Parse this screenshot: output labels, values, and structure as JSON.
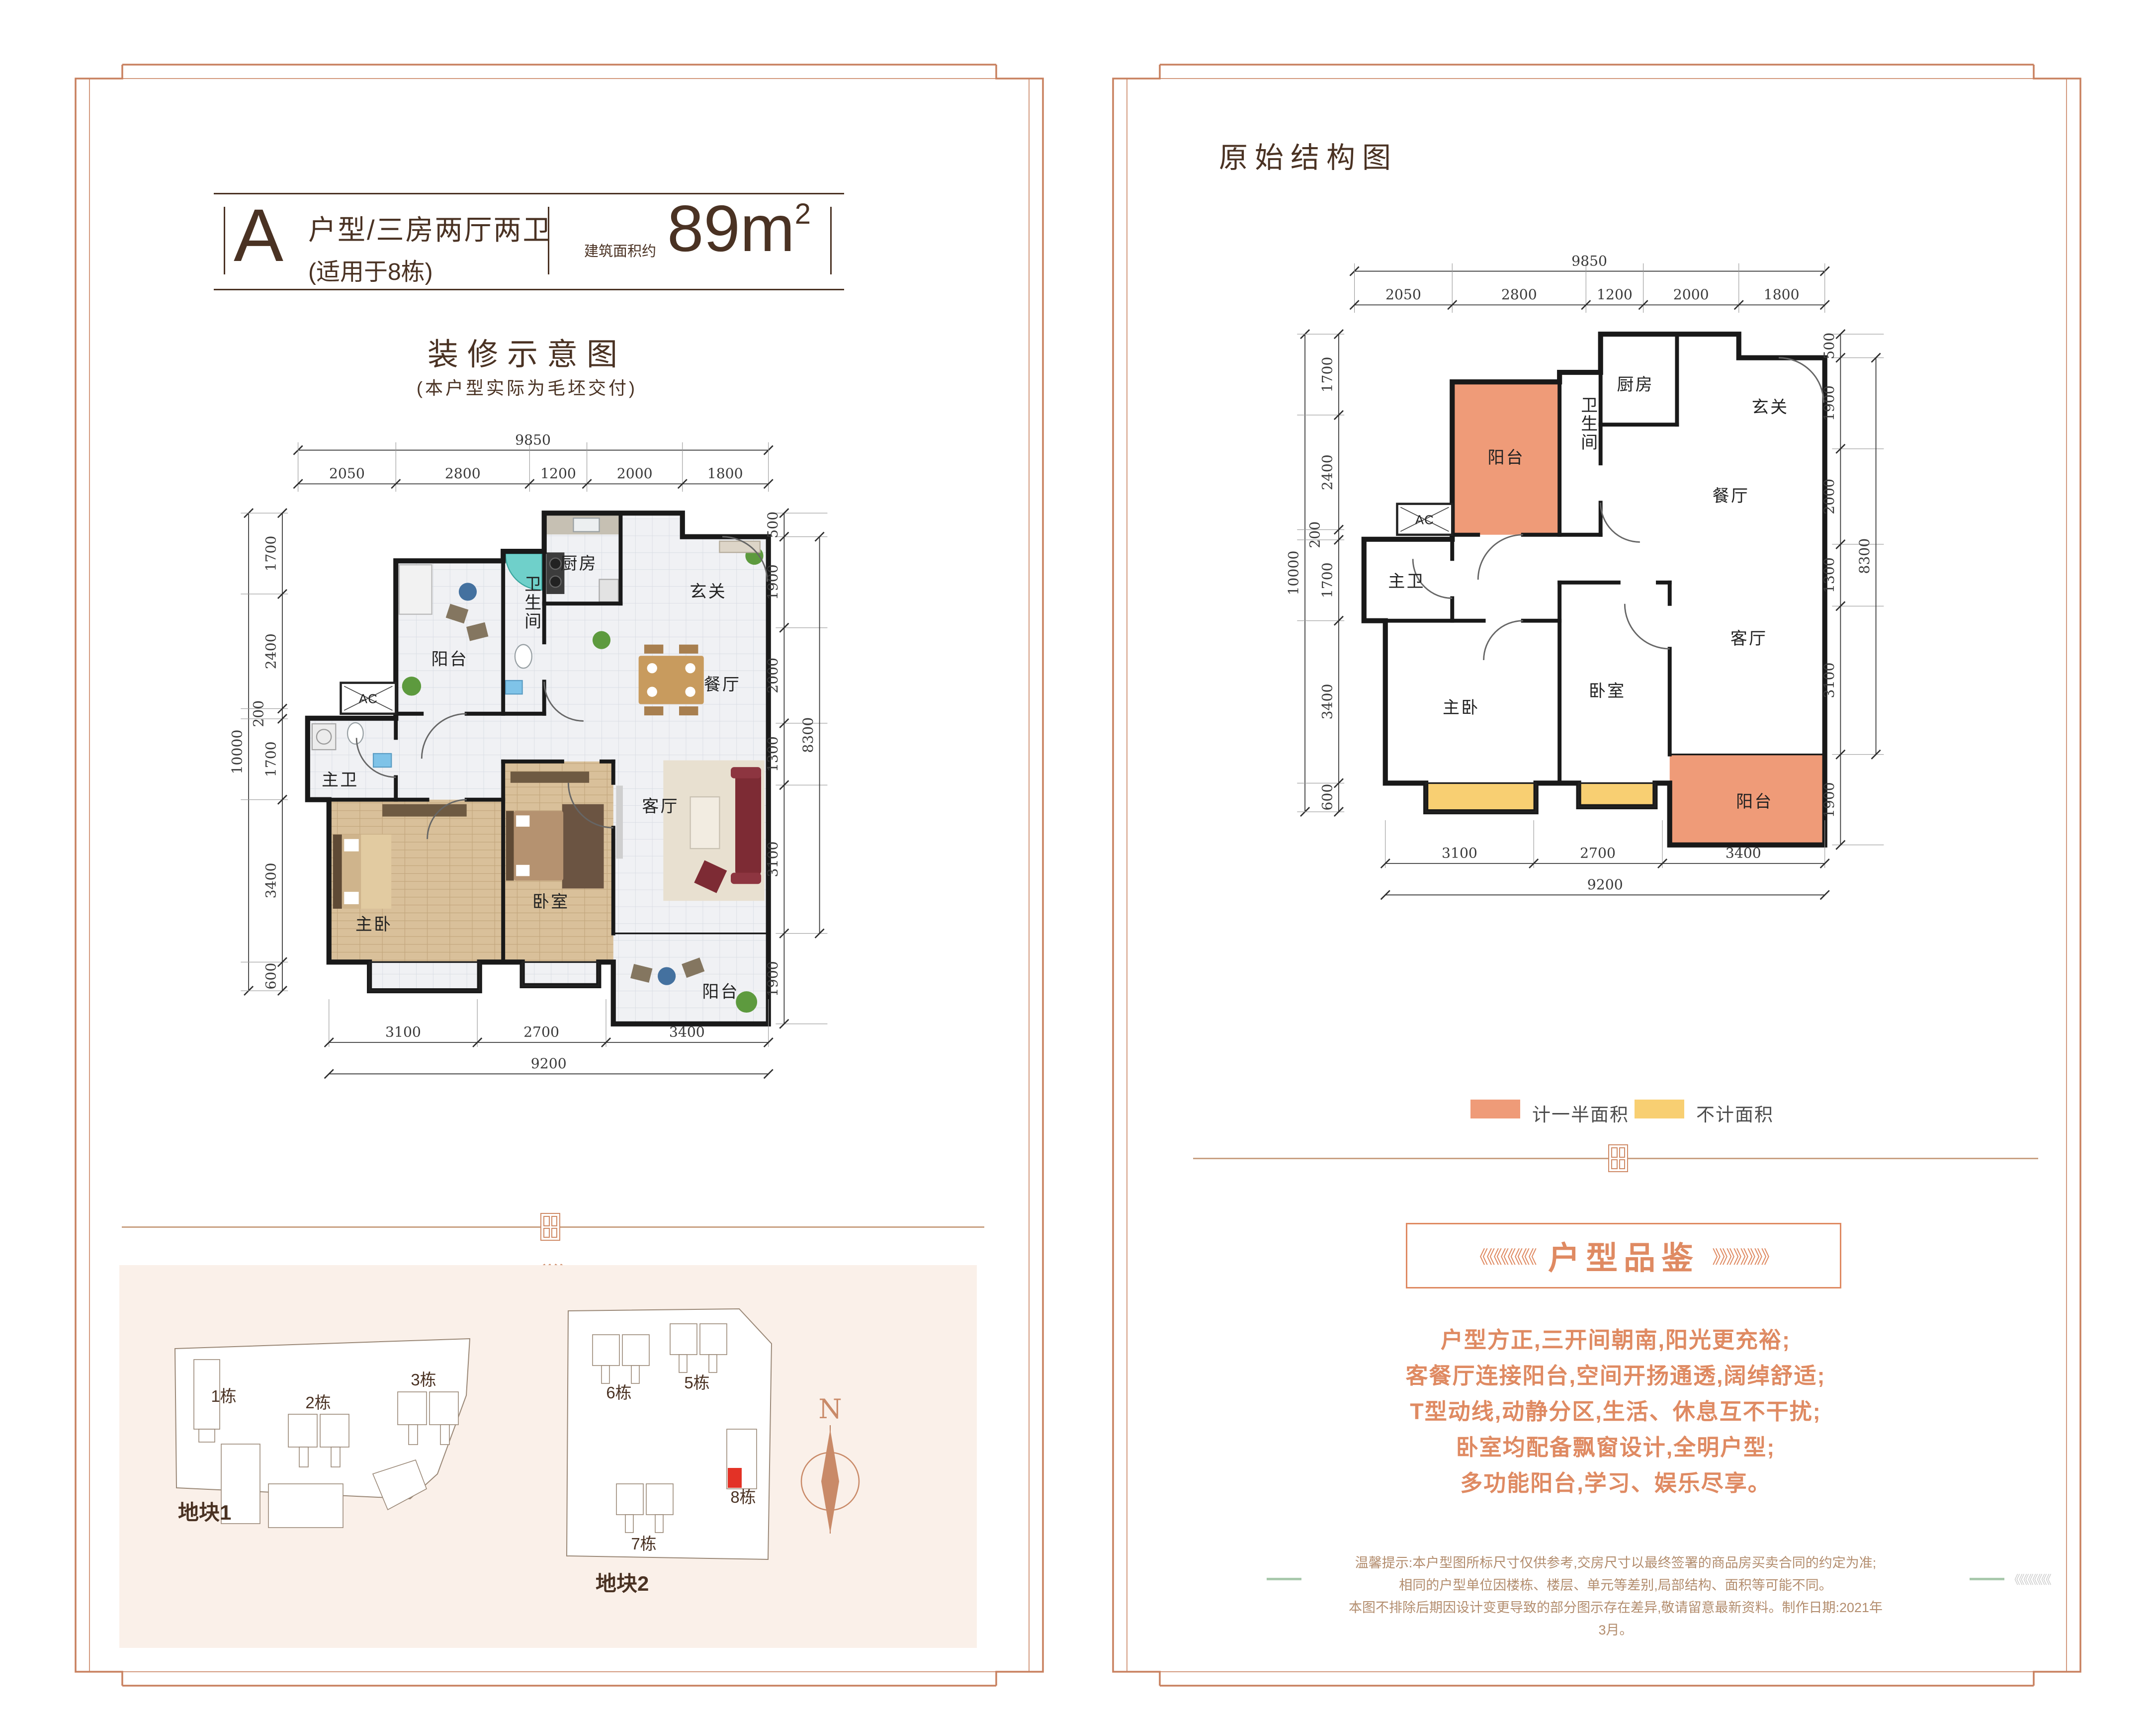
{
  "left_panel": {
    "header": {
      "type_letter": "A",
      "type_title": "户型/三房两厅两卫",
      "type_note": "(适用于8栋)",
      "area_label": "建筑面积约",
      "area_value": "89m",
      "area_exp": "2"
    },
    "plan_title": "装修示意图",
    "plan_subtitle": "(本户型实际为毛坯交付)",
    "site_plan": {
      "plot1_label": "地块1",
      "plot2_label": "地块2",
      "north_label": "N",
      "buildings": {
        "b1": "1栋",
        "b2": "2栋",
        "b3": "3栋",
        "b5": "5栋",
        "b6": "6栋",
        "b7": "7栋",
        "b8": "8栋"
      }
    }
  },
  "right_panel": {
    "title": "原始结构图",
    "legend": {
      "half_label": "计一半面积",
      "half_color": "#ef9b78",
      "none_label": "不计面积",
      "none_color": "#f8cf72"
    },
    "review": {
      "chevron_left": "《《《《《《《《",
      "title": "户型品鉴",
      "chevron_right": "》》》》》》》》",
      "lines": [
        "户型方正,三开间朝南,阳光更充裕;",
        "客餐厅连接阳台,空间开扬通透,阔绰舒适;",
        "T型动线,动静分区,生活、休息互不干扰;",
        "卧室均配备飘窗设计,全明户型;",
        "多功能阳台,学习、娱乐尽享。"
      ]
    },
    "disclaimer": [
      "温馨提示:本户型图所标尺寸仅供参考,交房尺寸以最终签署的商品房买卖合同的约定为准;",
      "相同的户型单位因楼栋、楼层、单元等差别,局部结构、面积等可能不同。",
      "本图不排除后期因设计变更导致的部分图示存在差异,敬请留意最新资料。制作日期:2021年3月。"
    ],
    "side_marks": "《《《《《《《《"
  },
  "plan_dims": {
    "top_total": "9850",
    "top": [
      "2050",
      "2800",
      "1200",
      "2000",
      "1800"
    ],
    "left_total": "10000",
    "left": [
      "1700",
      "2400",
      "200",
      "1700",
      "3400",
      "600"
    ],
    "right": [
      "500",
      "1900",
      "2000",
      "1300",
      "3100",
      "1900"
    ],
    "right_total": "8300",
    "bottom": [
      "3100",
      "2700",
      "3400"
    ],
    "bottom_total": "9200"
  },
  "rooms": {
    "kitchen": "厨房",
    "entry": "玄关",
    "dining": "餐厅",
    "bath": "卫生间",
    "balcony_top": "阳台",
    "master_bath": "主卫",
    "master_bed": "主卧",
    "bedroom": "卧室",
    "living": "客厅",
    "balcony_bottom": "阳台",
    "ac": "AC"
  }
}
